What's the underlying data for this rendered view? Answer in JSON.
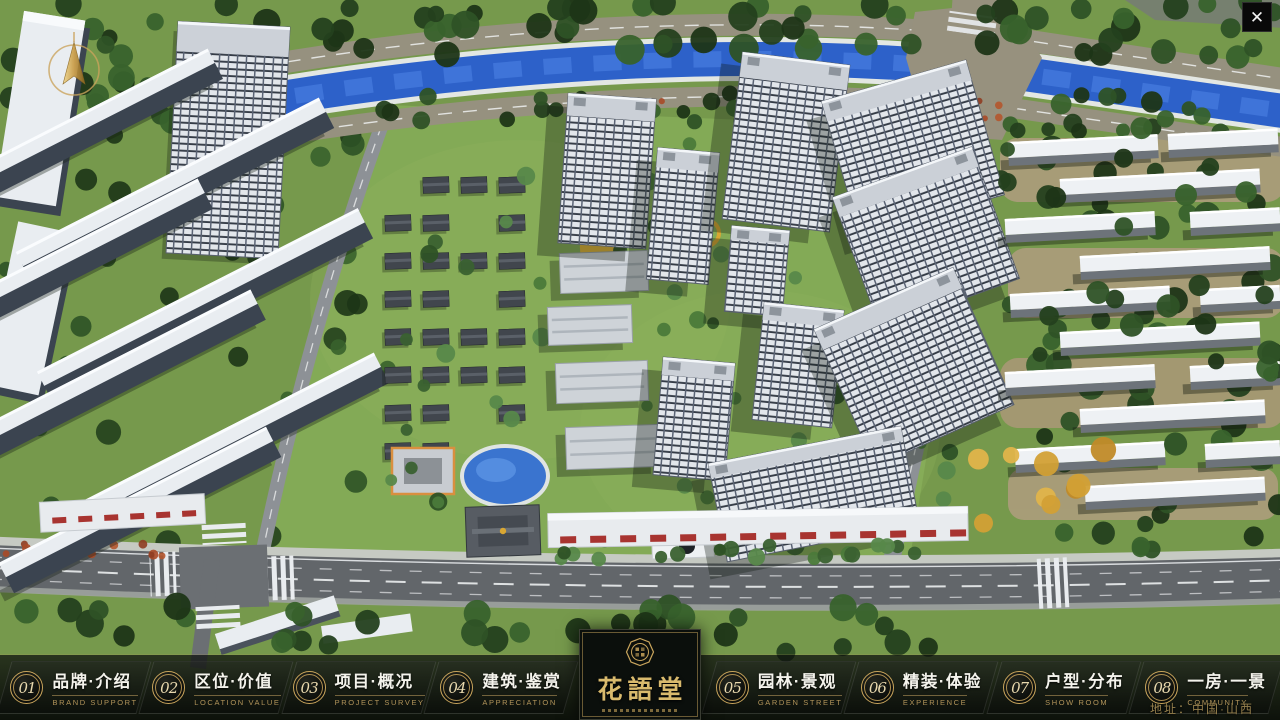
{
  "icons": {
    "close": "✕",
    "compass": "north-arrow",
    "logo_seal": "octagon-seal"
  },
  "navbar": {
    "items": [
      {
        "num": "01",
        "label": "品牌·介绍",
        "sub": "BRAND SUPPORT"
      },
      {
        "num": "02",
        "label": "区位·价值",
        "sub": "LOCATION VALUE"
      },
      {
        "num": "03",
        "label": "项目·概况",
        "sub": "PROJECT SURVEY"
      },
      {
        "num": "04",
        "label": "建筑·鉴赏",
        "sub": "APPRECIATION"
      },
      {
        "num": "05",
        "label": "园林·景观",
        "sub": "GARDEN STREET"
      },
      {
        "num": "06",
        "label": "精装·体验",
        "sub": "EXPERIENCE"
      },
      {
        "num": "07",
        "label": "户型·分布",
        "sub": "SHOW ROOM"
      },
      {
        "num": "08",
        "label": "一房·一景",
        "sub": "COMMUNITY"
      }
    ]
  },
  "logo": {
    "title": "花語堂"
  },
  "footer": {
    "address": "地址：中国·山西"
  },
  "colors": {
    "gold": "#c9a55c",
    "gold_dim": "#96804d",
    "bar_bg": "#0a0d0b",
    "river": "#2d61c9",
    "grass": "#76994c"
  }
}
